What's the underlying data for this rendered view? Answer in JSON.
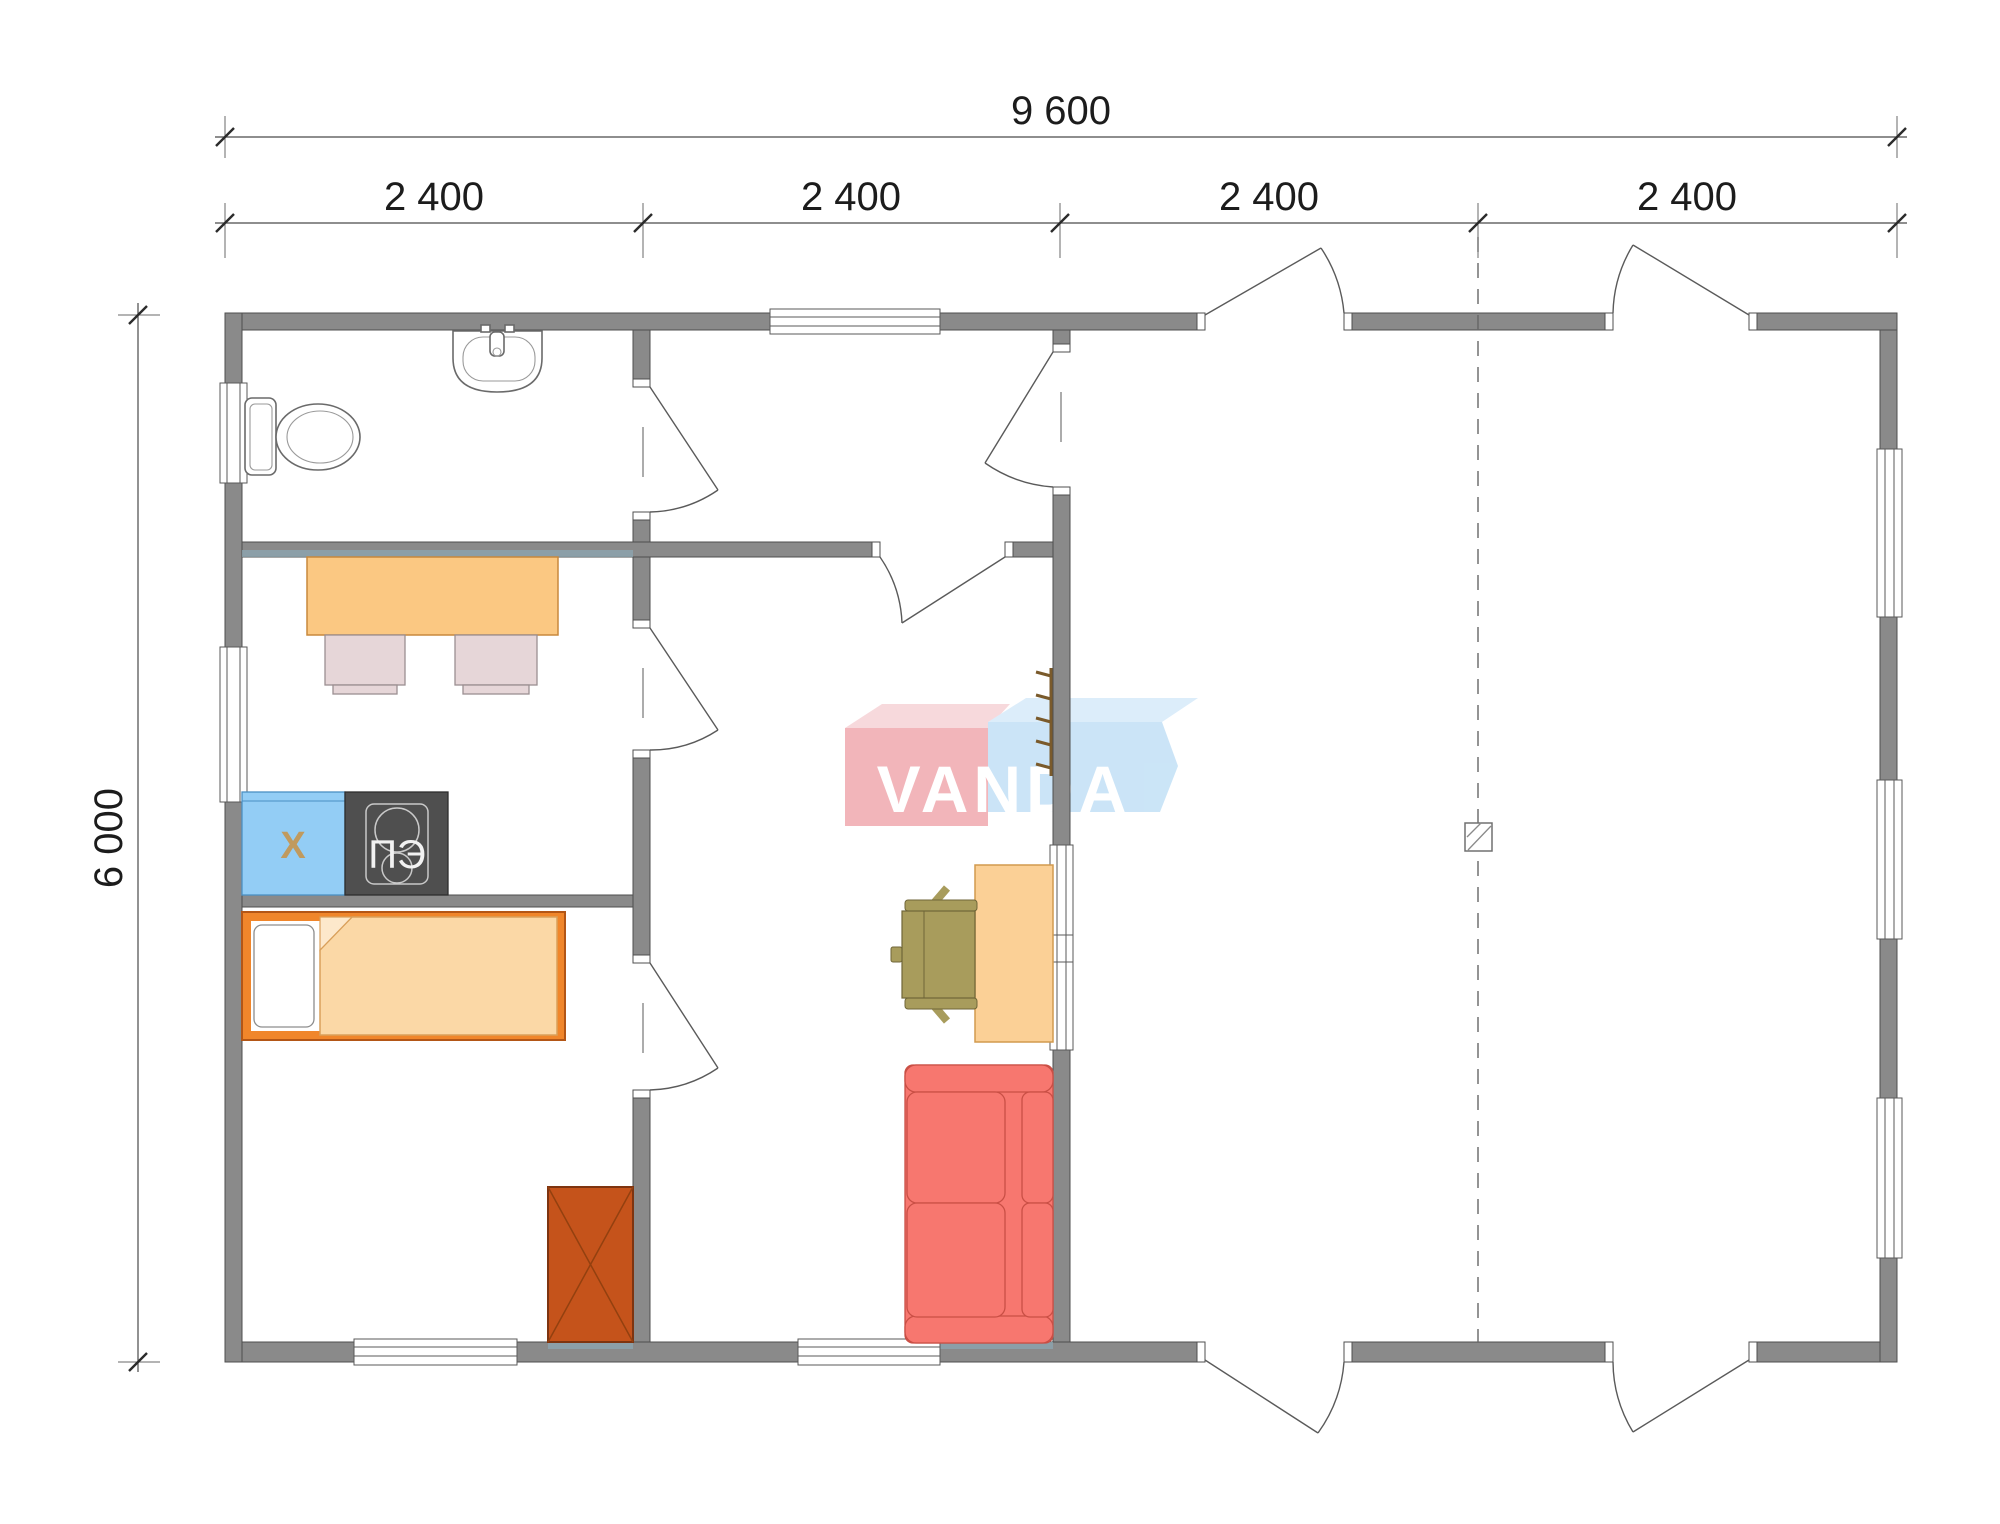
{
  "dimensions": {
    "overall_width": "9 600",
    "overall_depth": "6 000",
    "modules": [
      "2 400",
      "2 400",
      "2 400",
      "2 400"
    ]
  },
  "furniture": {
    "fridge_label": "Х",
    "stove_label": "ПЭ"
  },
  "logo": {
    "text": "VANDA"
  },
  "colors": {
    "wall_gray": "#8a8a8a",
    "bed_frame_orange": "#f0862b",
    "blanket_peach": "#fbd8a6",
    "table_orange": "#fbc882",
    "chair_pink": "#e6d6d8",
    "fridge_blue": "#93cdf5",
    "stove_dark": "#4f4f4f",
    "wardrobe_rust": "#c5531b",
    "sofa_red": "#f7776f",
    "desk_peach": "#fbd096",
    "office_chair_olive": "#a89c5c",
    "logo_pink": "#f1abb1",
    "logo_blue": "#c4e1f6"
  }
}
